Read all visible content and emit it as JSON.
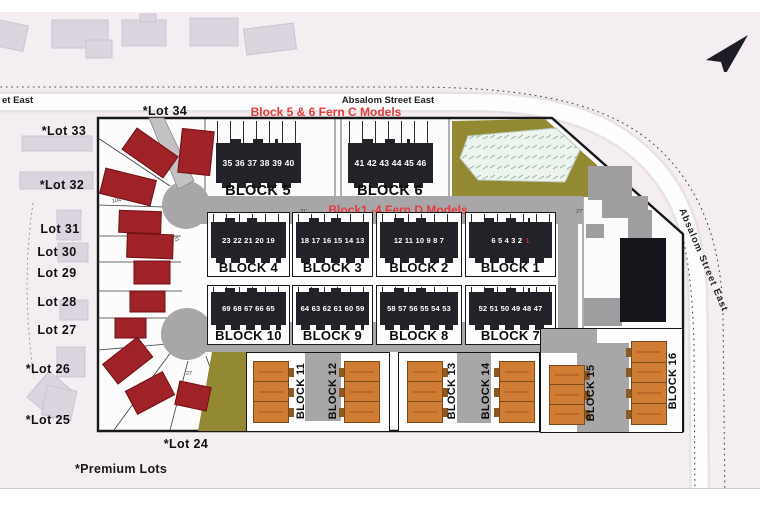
{
  "page": {
    "street_left": "et East",
    "street_top": "Absalom Street East",
    "street_right": "Absalom Street East",
    "premium_note": "*Premium Lots",
    "annotation_fern_c": "Block 5 & 6 Fern C Models",
    "annotation_fern_d": "Block1 -4 Fern D Models"
  },
  "lots": [
    "*Lot 34",
    "*Lot 33",
    "*Lot 32",
    "Lot 31",
    "Lot 30",
    "Lot 29",
    "Lot 28",
    "Lot 27",
    "*Lot 26",
    "*Lot 25",
    "*Lot 24"
  ],
  "blocks": {
    "b5": {
      "label": "BLOCK 5",
      "units": "35 36 37 38 39 40"
    },
    "b6": {
      "label": "BLOCK 6",
      "units": "41 42 43 44 45 46"
    },
    "b4": {
      "label": "BLOCK 4",
      "units": "23 22 21 20 19"
    },
    "b3": {
      "label": "BLOCK 3",
      "units": "18 17 16 15 14 13"
    },
    "b2": {
      "label": "BLOCK 2",
      "units": "12 11 10 9 8 7"
    },
    "b1": {
      "label": "BLOCK 1",
      "units": "6 5 4 3 2",
      "last_unit": "1"
    },
    "b10": {
      "label": "BLOCK 10",
      "units": "69 68 67 66 65"
    },
    "b9": {
      "label": "BLOCK 9",
      "units": "64 63 62 61 60 59"
    },
    "b8": {
      "label": "BLOCK 8",
      "units": "58 57 56 55 54 53"
    },
    "b7": {
      "label": "BLOCK 7",
      "units": "52 51 50 49 48 47"
    },
    "b11": {
      "label": "BLOCK 11"
    },
    "b12": {
      "label": "BLOCK 12"
    },
    "b13": {
      "label": "BLOCK 13"
    },
    "b14": {
      "label": "BLOCK 14"
    },
    "b15": {
      "label": "BLOCK 15"
    },
    "b16": {
      "label": "BLOCK 16"
    }
  },
  "dimensions": {
    "d104": "104",
    "d31": "31",
    "d27": "27",
    "d31f": "31'",
    "d27f": "27'"
  },
  "colors": {
    "road": "#a9a6aa",
    "plat_fill": "#fcfcfd",
    "olive": "#938933",
    "pond": "#edf4ee",
    "model_building": "#222228",
    "orange_building": "#cf7c34",
    "red_building": "#9e2227",
    "existing_building": "#a09da1",
    "dark_building": "#14141a",
    "annotation_red": "#e23c3c",
    "unit1_red": "#cc2222"
  }
}
